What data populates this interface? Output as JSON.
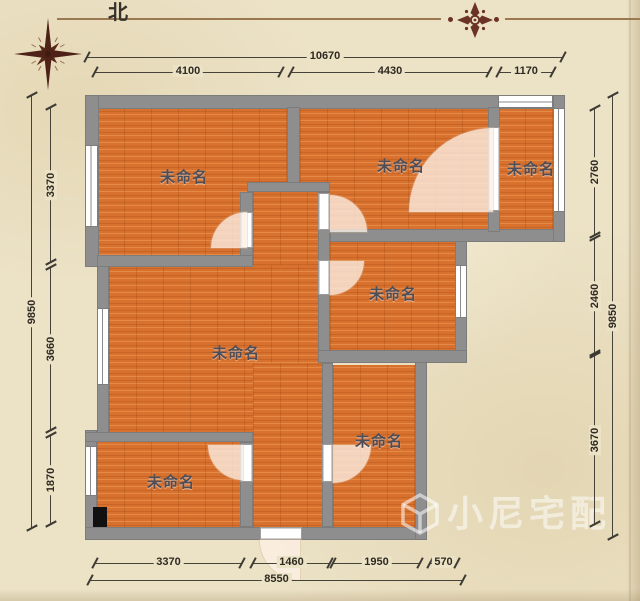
{
  "compass": {
    "north_label": "北"
  },
  "rooms": {
    "top_left": {
      "label": "未命名"
    },
    "top_middle": {
      "label": "未命名"
    },
    "top_right": {
      "label": "未命名"
    },
    "middle_right": {
      "label": "未命名"
    },
    "living": {
      "label": "未命名"
    },
    "bottom_right": {
      "label": "未命名"
    },
    "bottom_left": {
      "label": "未命名"
    }
  },
  "dims": {
    "top": {
      "total": "10670",
      "segments": [
        "4100",
        "4430",
        "1170"
      ]
    },
    "left": {
      "total": "9850",
      "segments": [
        "3370",
        "3660",
        "1870"
      ]
    },
    "right": {
      "total": "9850",
      "segments": [
        "2760",
        "2460",
        "3670"
      ]
    },
    "bottom": {
      "total": "8550",
      "segments": [
        "3370",
        "1460",
        "1950",
        "570"
      ]
    }
  },
  "watermark": {
    "brand": "小尼宅配"
  },
  "colors": {
    "paper": "#ece2c6",
    "wall": "#8e8e8e",
    "floor": "#d9712e",
    "dimension_line": "#45423a",
    "compass": "#5a281c",
    "ornament": "#6b3226",
    "watermark": "rgba(255,255,255,0.52)"
  }
}
